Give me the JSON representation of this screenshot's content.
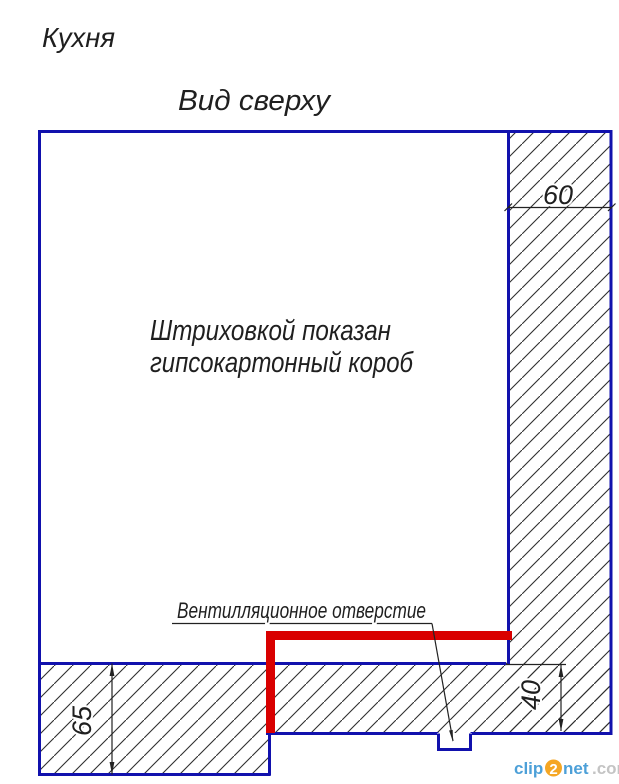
{
  "titles": {
    "room_title": "Кухня",
    "view_title": "Вид сверху"
  },
  "annotations": {
    "hatch_note_line1": "Штриховкой показан",
    "hatch_note_line2": "гипсокартонный короб",
    "vent_label": "Вентилляционное отверстие"
  },
  "dimensions": {
    "right_box_width": "60",
    "bottom_left_depth": "65",
    "bottom_right_depth": "40"
  },
  "watermark": {
    "part1": "clip",
    "part2": "2",
    "part3": "net",
    "part4": ".com"
  },
  "colors": {
    "outline_blue": "#1111ad",
    "vent_red": "#d90000",
    "hatch_gray": "#2f2f2f",
    "watermark_blue": "#4da0d8",
    "watermark_orange": "#f5a623",
    "watermark_gray": "#c4c4c4"
  }
}
